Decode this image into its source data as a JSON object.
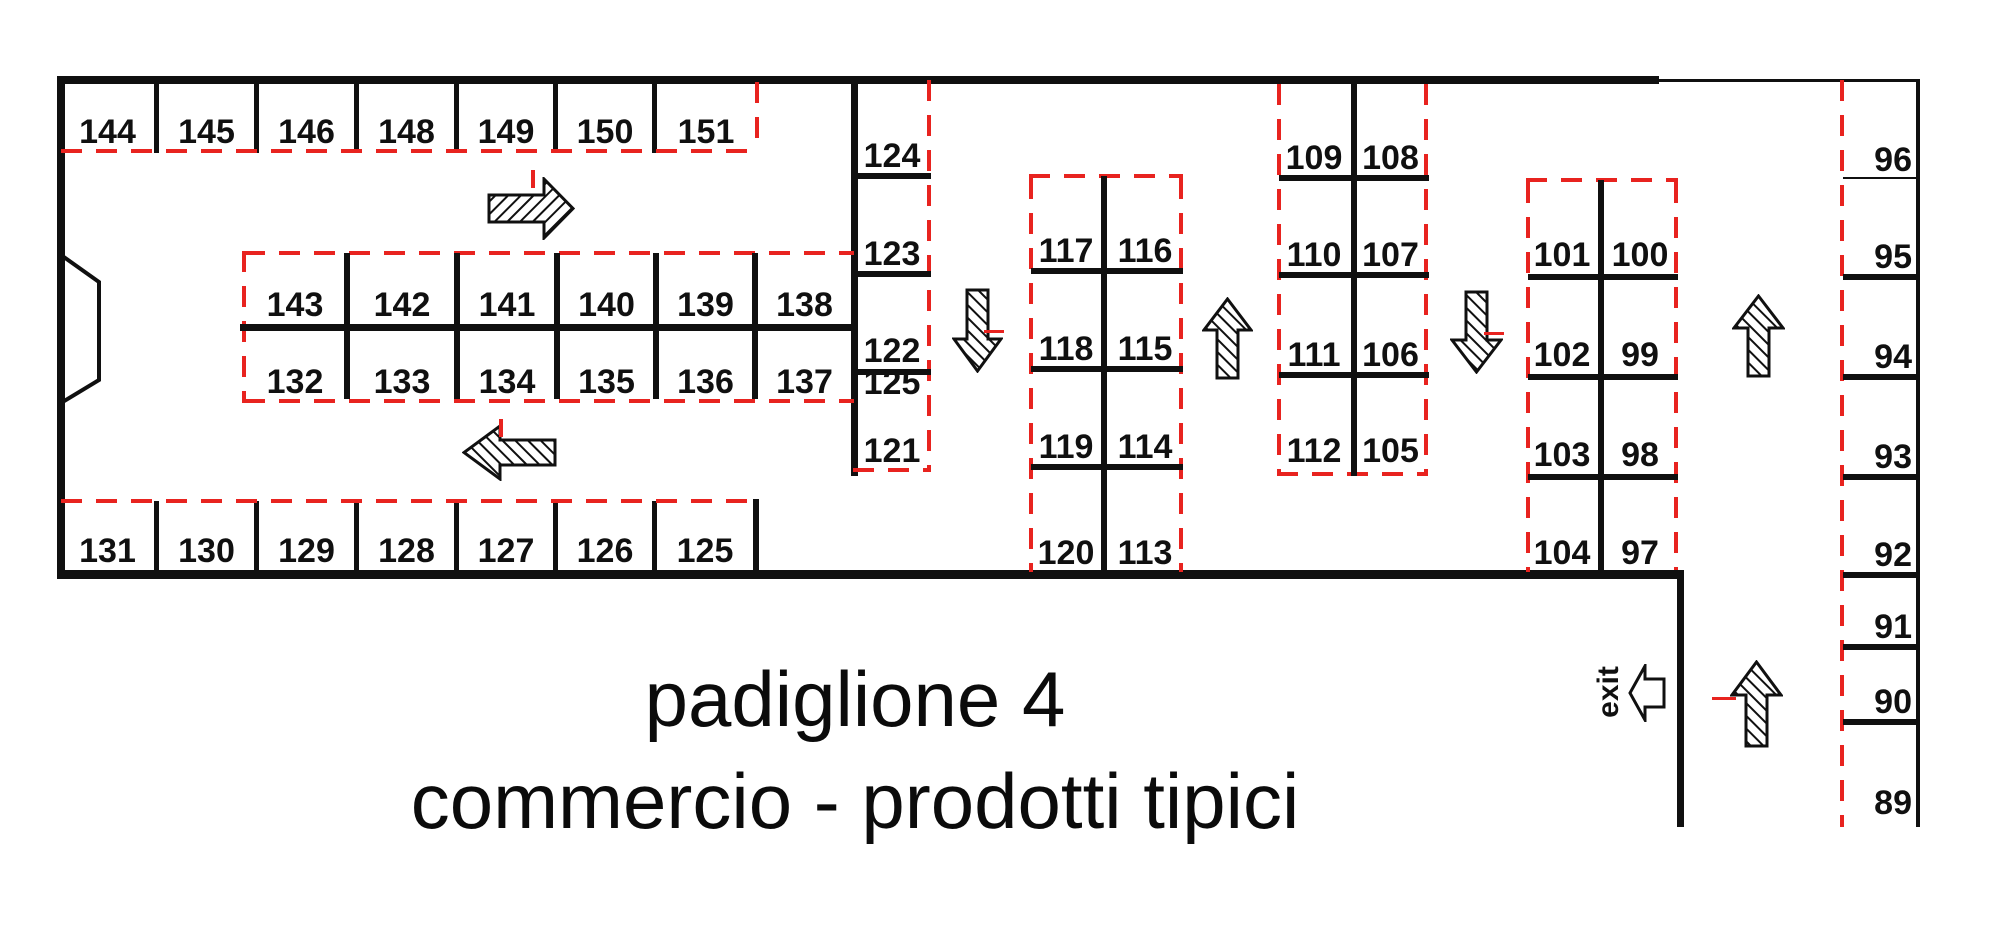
{
  "meta": {
    "title_line1": "padiglione 4",
    "title_line2": "commercio - prodotti tipici",
    "exit_label": "exit"
  },
  "colors": {
    "ink": "#101010",
    "red": "#e8231f"
  },
  "rows": {
    "top": [
      "144",
      "145",
      "146",
      "148",
      "149",
      "150",
      "151"
    ],
    "bottom": [
      "131",
      "130",
      "129",
      "128",
      "127",
      "126",
      "125"
    ],
    "island_top": [
      "143",
      "142",
      "141",
      "140",
      "139",
      "138"
    ],
    "island_bottom": [
      "132",
      "133",
      "134",
      "135",
      "136",
      "137"
    ],
    "strip": [
      "124",
      "123",
      "122",
      "125",
      "121"
    ],
    "block_a": [
      "117",
      "116",
      "118",
      "115",
      "119",
      "114",
      "120",
      "113"
    ],
    "block_b": [
      "109",
      "108",
      "110",
      "107",
      "111",
      "106",
      "112",
      "105"
    ],
    "block_c": [
      "101",
      "100",
      "102",
      "99",
      "103",
      "98",
      "104",
      "97"
    ],
    "right_strip": [
      "96",
      "95",
      "94",
      "93",
      "92",
      "91",
      "90",
      "89"
    ]
  },
  "arrows": {
    "top_corridor": "right",
    "mid_corridor": "left",
    "aisle_1": "down",
    "aisle_2": "up",
    "aisle_3": "down",
    "aisle_4": "up",
    "exit_aisle": "up",
    "exit_door": "left-hollow"
  }
}
